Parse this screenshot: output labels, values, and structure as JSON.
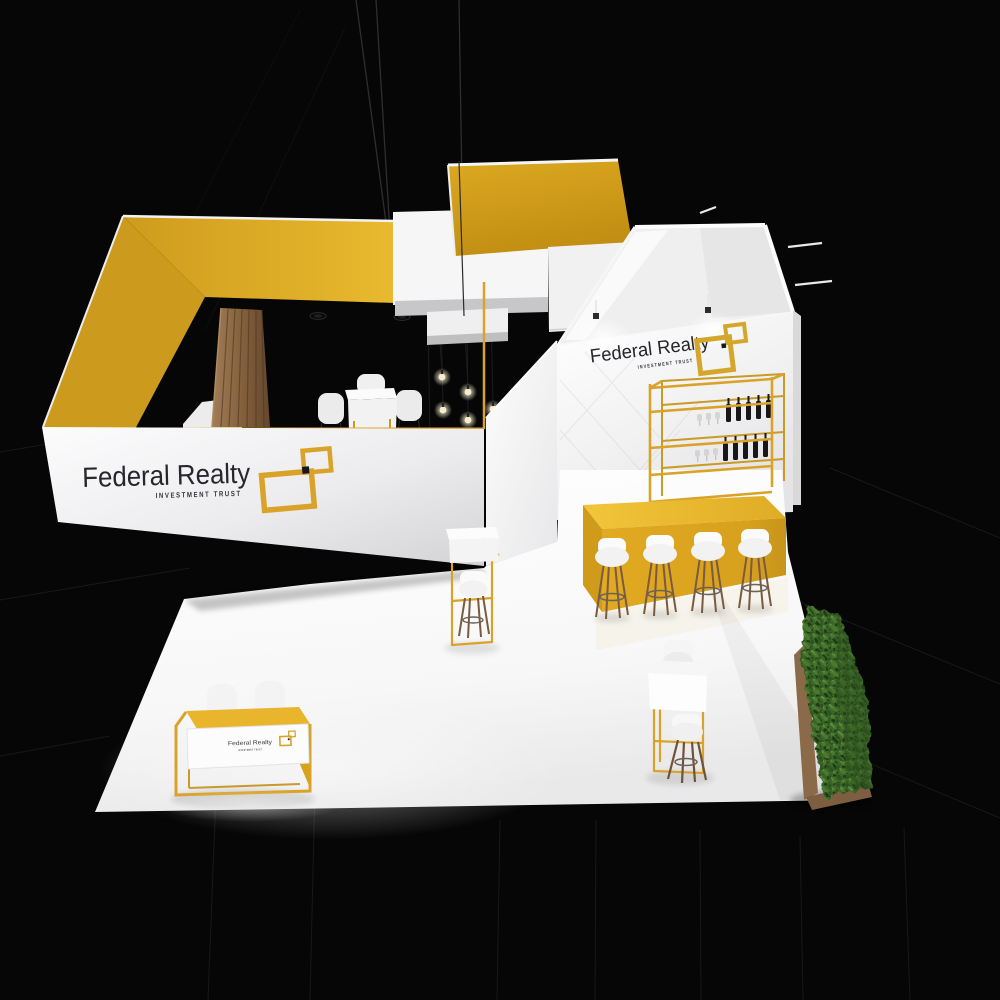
{
  "brand": {
    "name": "Federal Realty",
    "tagline": "INVESTMENT TRUST"
  },
  "signs": {
    "main_fascia": {
      "title": "Federal Realty",
      "tagline": "INVESTMENT TRUST"
    },
    "back_wall": {
      "title": "Federal Realty",
      "tagline": "INVESTMENT TRUST"
    },
    "reception": {
      "title": "Federal Realty",
      "tagline": "INVESTMENT TRUST"
    }
  },
  "icons": {
    "logo_mark": "overlapping-squares"
  },
  "scene": {
    "bar_stool_count": 4,
    "wine_bottle_rows": 2,
    "pendant_bulb_count": 6
  },
  "colors": {
    "accent": "#D9A32A",
    "canopy_yellow": "#D4A01C",
    "counter_yellow": "#DFA61F",
    "panel_white": "#F4F4F4",
    "background": "#060606",
    "wood": "#8A6A4C",
    "hedge_green": "#3C6627",
    "text_dark": "#26262c"
  }
}
